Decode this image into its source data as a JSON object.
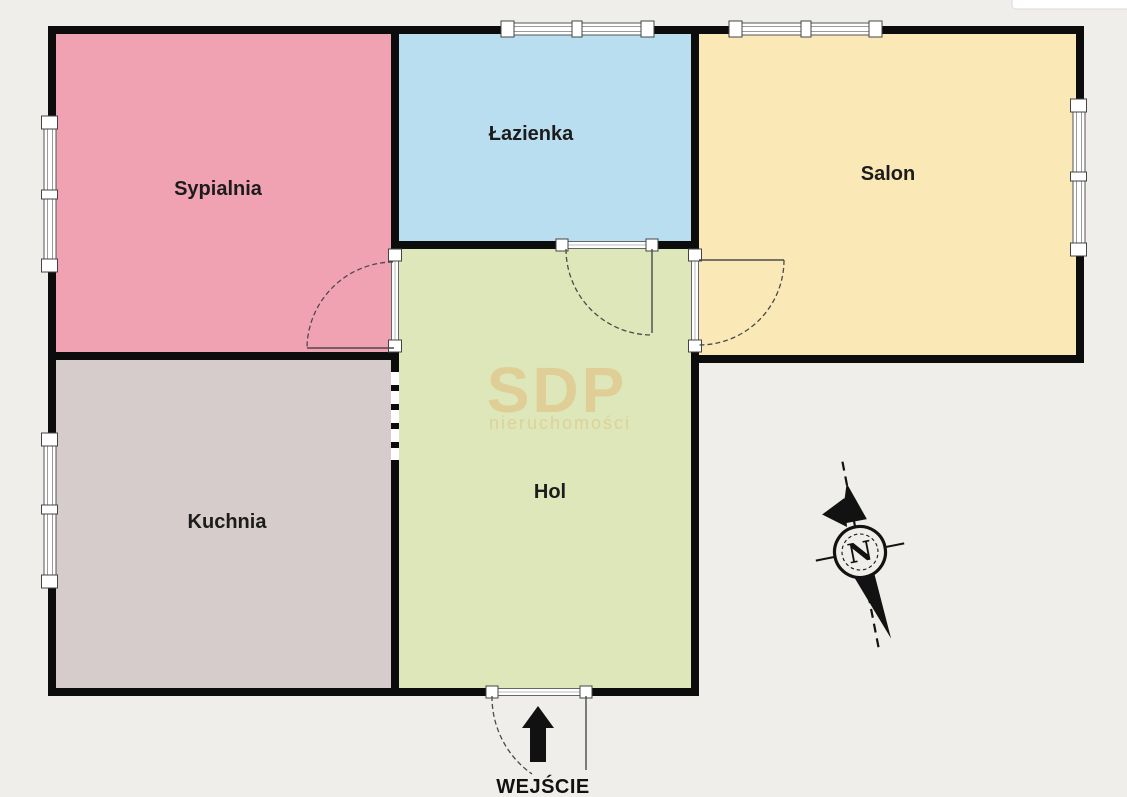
{
  "palette": {
    "background": "#f0eeeb",
    "wall": "#0c0c0c",
    "chip": "#ffffff"
  },
  "rooms": [
    {
      "id": "sypialnia",
      "label": "Sypialnia",
      "color": "#f0a1b2"
    },
    {
      "id": "lazienka",
      "label": "Łazienka",
      "color": "#b8def0"
    },
    {
      "id": "salon",
      "label": "Salon",
      "color": "#fae8b6"
    },
    {
      "id": "kuchnia",
      "label": "Kuchnia",
      "color": "#d5cccb"
    },
    {
      "id": "hol",
      "label": "Hol",
      "color": "#dee7ba"
    }
  ],
  "entrance": {
    "label": "WEJŚCIE"
  },
  "compass": {
    "label": "N"
  },
  "watermark": {
    "title": "SDP",
    "subtitle": "nieruchomości"
  }
}
